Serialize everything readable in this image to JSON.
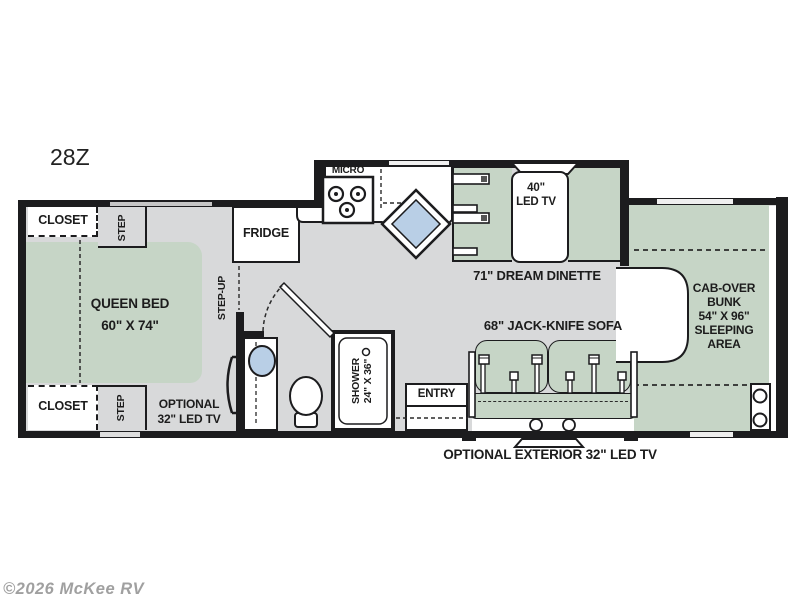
{
  "page": {
    "plan_code": "28Z",
    "watermark": "©2026 McKee RV"
  },
  "colors": {
    "wall": "#1c1c1e",
    "floor": "#d8d9da",
    "furniture_green": "#c6d5c6",
    "sink_blue": "#b9cfe6",
    "text": "#1c1c1c",
    "watermark_gray": "#a0a0a0"
  },
  "floorplan": {
    "bedroom": {
      "closet_top": "CLOSET",
      "step_top": "STEP",
      "bed_line1": "QUEEN BED",
      "bed_line2": "60\" X 74\"",
      "closet_bottom": "CLOSET",
      "step_bottom": "STEP",
      "optional_tv_line1": "OPTIONAL",
      "optional_tv_line2": "32\" LED TV",
      "step_up": "STEP-UP"
    },
    "kitchen": {
      "fridge": "FRIDGE",
      "micro": "MICRO"
    },
    "dinette": {
      "tv_line1": "40\"",
      "tv_line2": "LED TV",
      "label": "71\" DREAM DINETTE"
    },
    "bathroom": {
      "shower_line1": "SHOWER",
      "shower_line2": "24\" X 36\""
    },
    "living": {
      "sofa": "68\" JACK-KNIFE SOFA",
      "entry": "ENTRY",
      "exterior_tv": "OPTIONAL EXTERIOR 32\" LED TV"
    },
    "bunk": {
      "line1": "CAB-OVER",
      "line2": "BUNK",
      "line3": "54\" X 96\"",
      "line4": "SLEEPING",
      "line5": "AREA"
    }
  }
}
